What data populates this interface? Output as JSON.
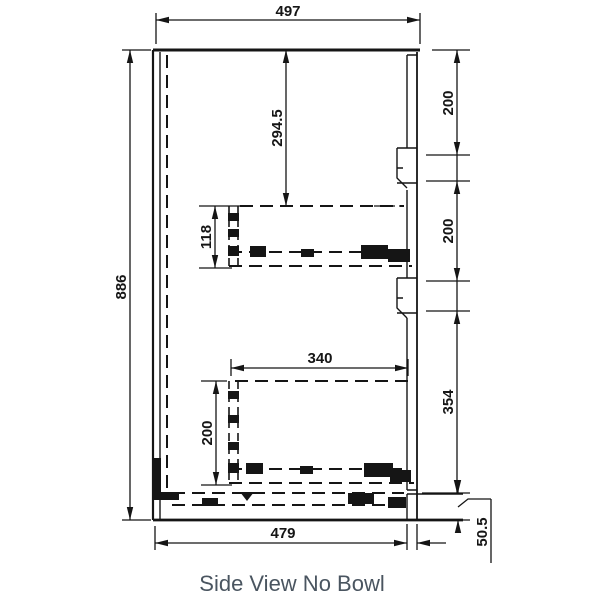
{
  "caption": "Side View No Bowl",
  "dimensions": {
    "top_width": "497",
    "overall_height": "886",
    "top_to_upper_drawer": "294.5",
    "upper_drawer_height": "118",
    "lower_drawer_length": "340",
    "lower_drawer_height": "200",
    "front_top_panel": "200",
    "front_middle_panel": "200",
    "front_bottom_panel": "354",
    "kickboard_height": "50.5",
    "bottom_width": "479"
  },
  "colors": {
    "line": "#151515",
    "caption_text": "#4a5560",
    "background": "#ffffff"
  }
}
